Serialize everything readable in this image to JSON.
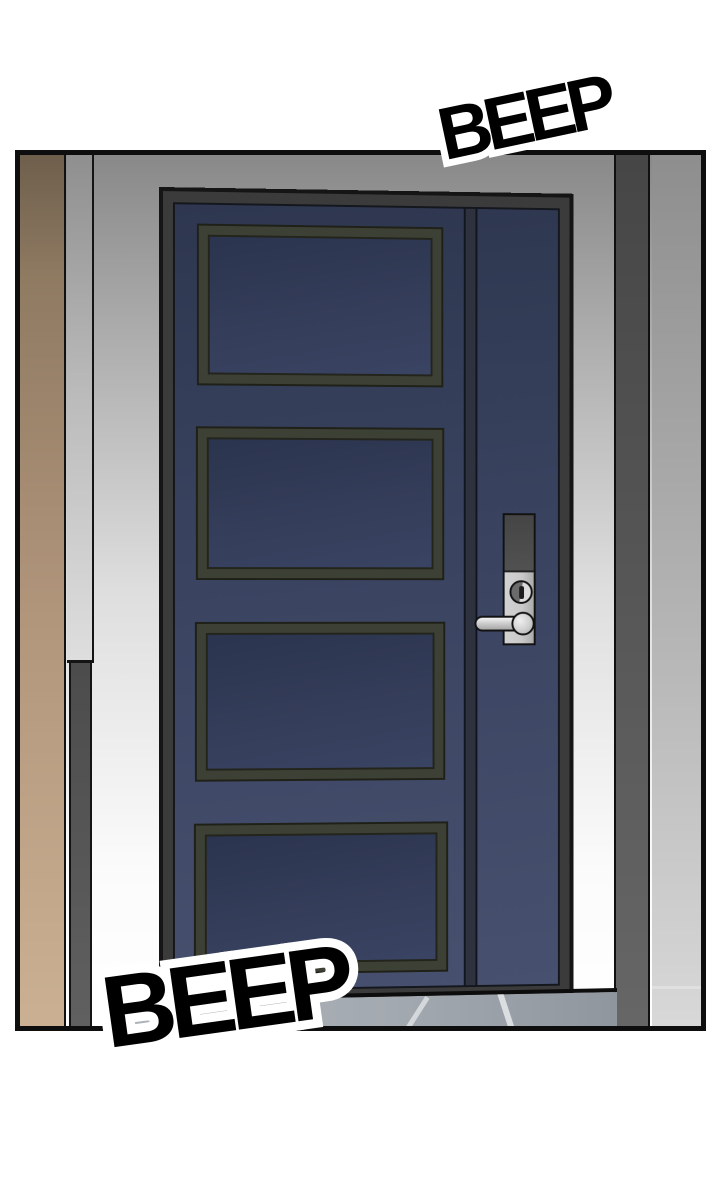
{
  "scene": {
    "type": "comic-panel",
    "description": "Closed navy four-panel apartment door with electronic keypad lock and lever handle, seen from a hallway; beige wall edge on left, dark pillar on right, gray floor below"
  },
  "sfx": {
    "top": {
      "text": "BEEP"
    },
    "bottom": {
      "text": "BEEP"
    }
  },
  "door": {
    "panel_count": 4,
    "hardware": [
      "keypad-cover",
      "keyhole",
      "lever-handle"
    ]
  },
  "colors": {
    "page_background": "#ffffff",
    "panel_outline": "#0e0e0e",
    "door_navy": "#3b4562",
    "door_panel_inset": "#343d59",
    "door_panel_molding": "#3d4034",
    "door_frame": "#3b3b3b",
    "door_groove": "#2d323e",
    "wall_left_tan": "#b3977d",
    "wall_gray": "#a8a8a8",
    "pillar_dark": "#585858",
    "right_wall_gray": "#b5b5b5",
    "floor_gray": "#a3a9b0",
    "floor_streak": "#d5d8db",
    "lock_silver": "#c9c9c9",
    "lock_keypad_dark": "#4d4d4d",
    "handle_silver": "#cfcfcf",
    "sfx_fill": "#000000",
    "sfx_outline": "#ffffff"
  }
}
